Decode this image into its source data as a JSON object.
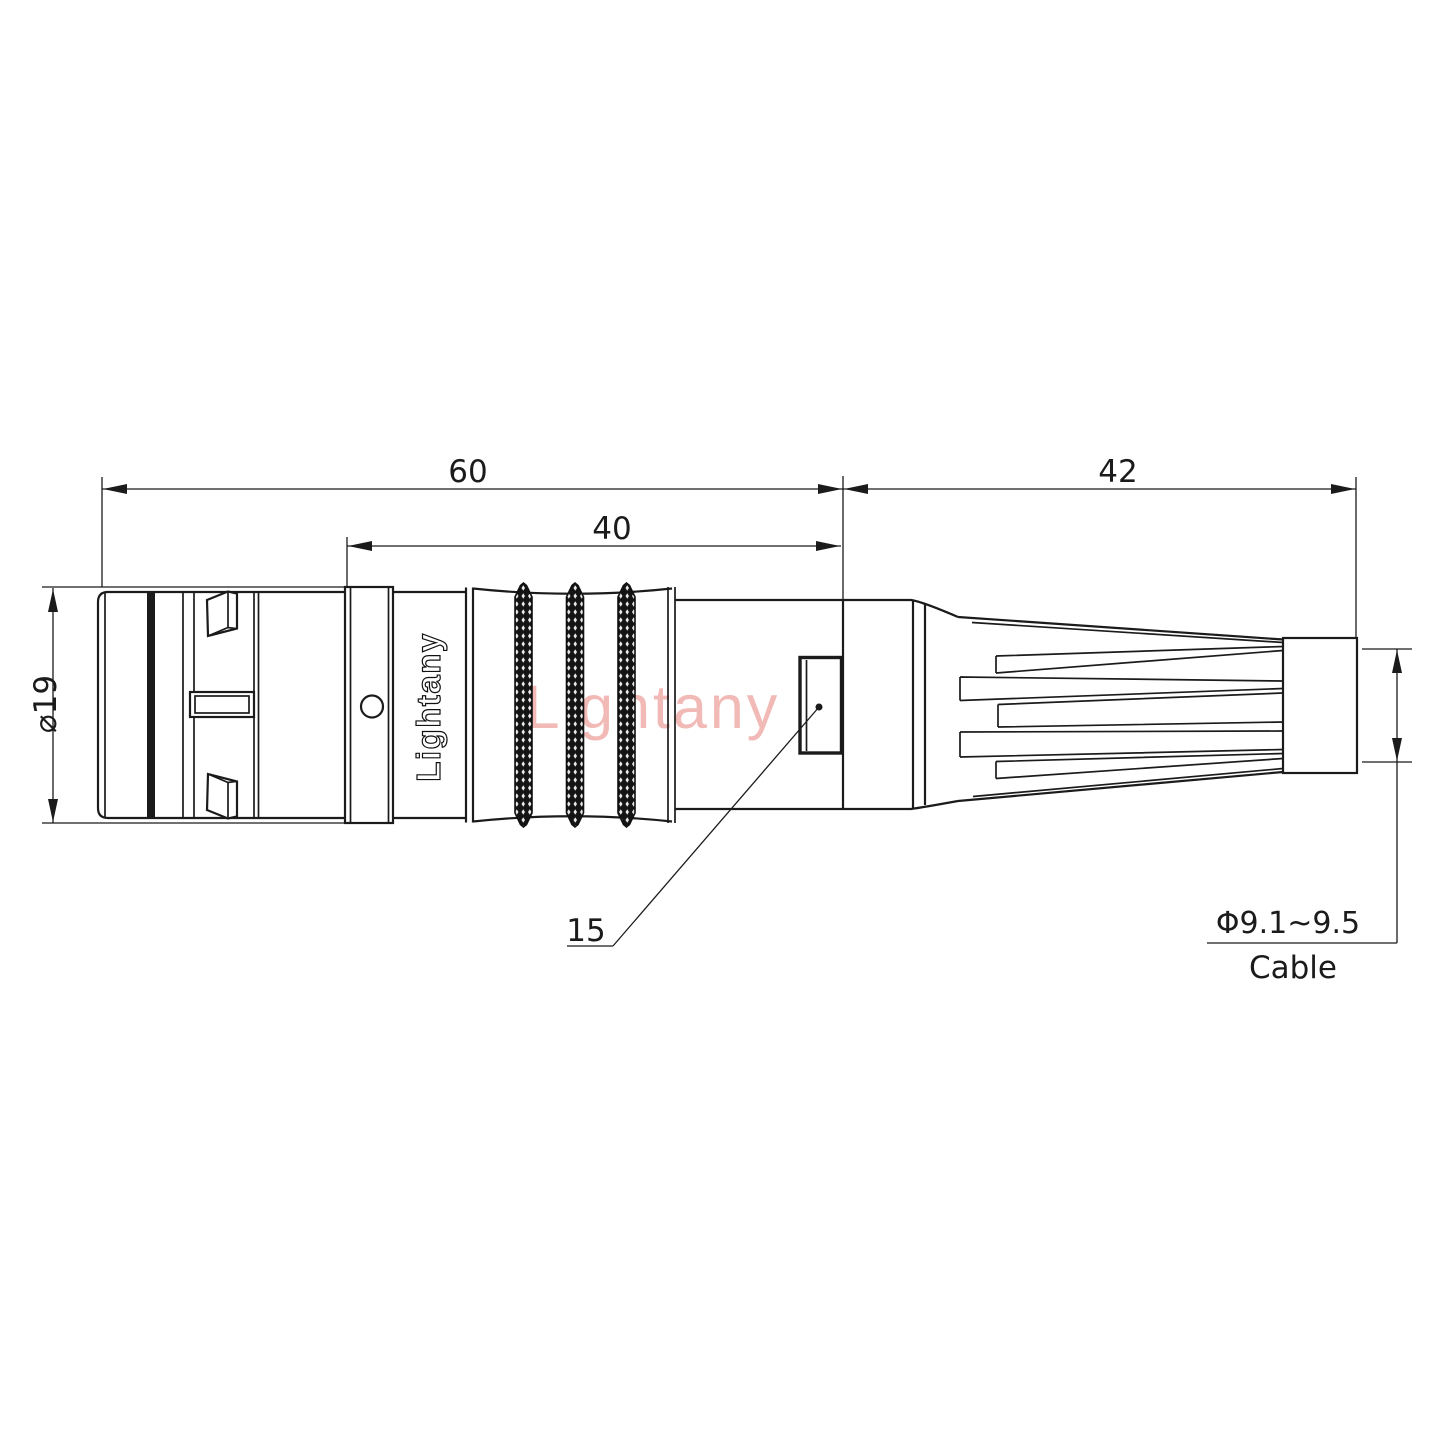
{
  "drawing": {
    "brand": {
      "watermark": "Lightany",
      "body_marking": "Lightany"
    },
    "dimensions": {
      "overall_length": "60",
      "front_section_length": "40",
      "boot_length": "42",
      "body_diameter": "⌀19",
      "window_offset": "15",
      "cable_diameter": "Φ9.1~9.5",
      "cable_label": "Cable"
    },
    "colors": {
      "line": "#1b1b1b",
      "watermark_pink": "#f2bab6",
      "knurl_black": "#141414",
      "background": "#ffffff"
    }
  }
}
